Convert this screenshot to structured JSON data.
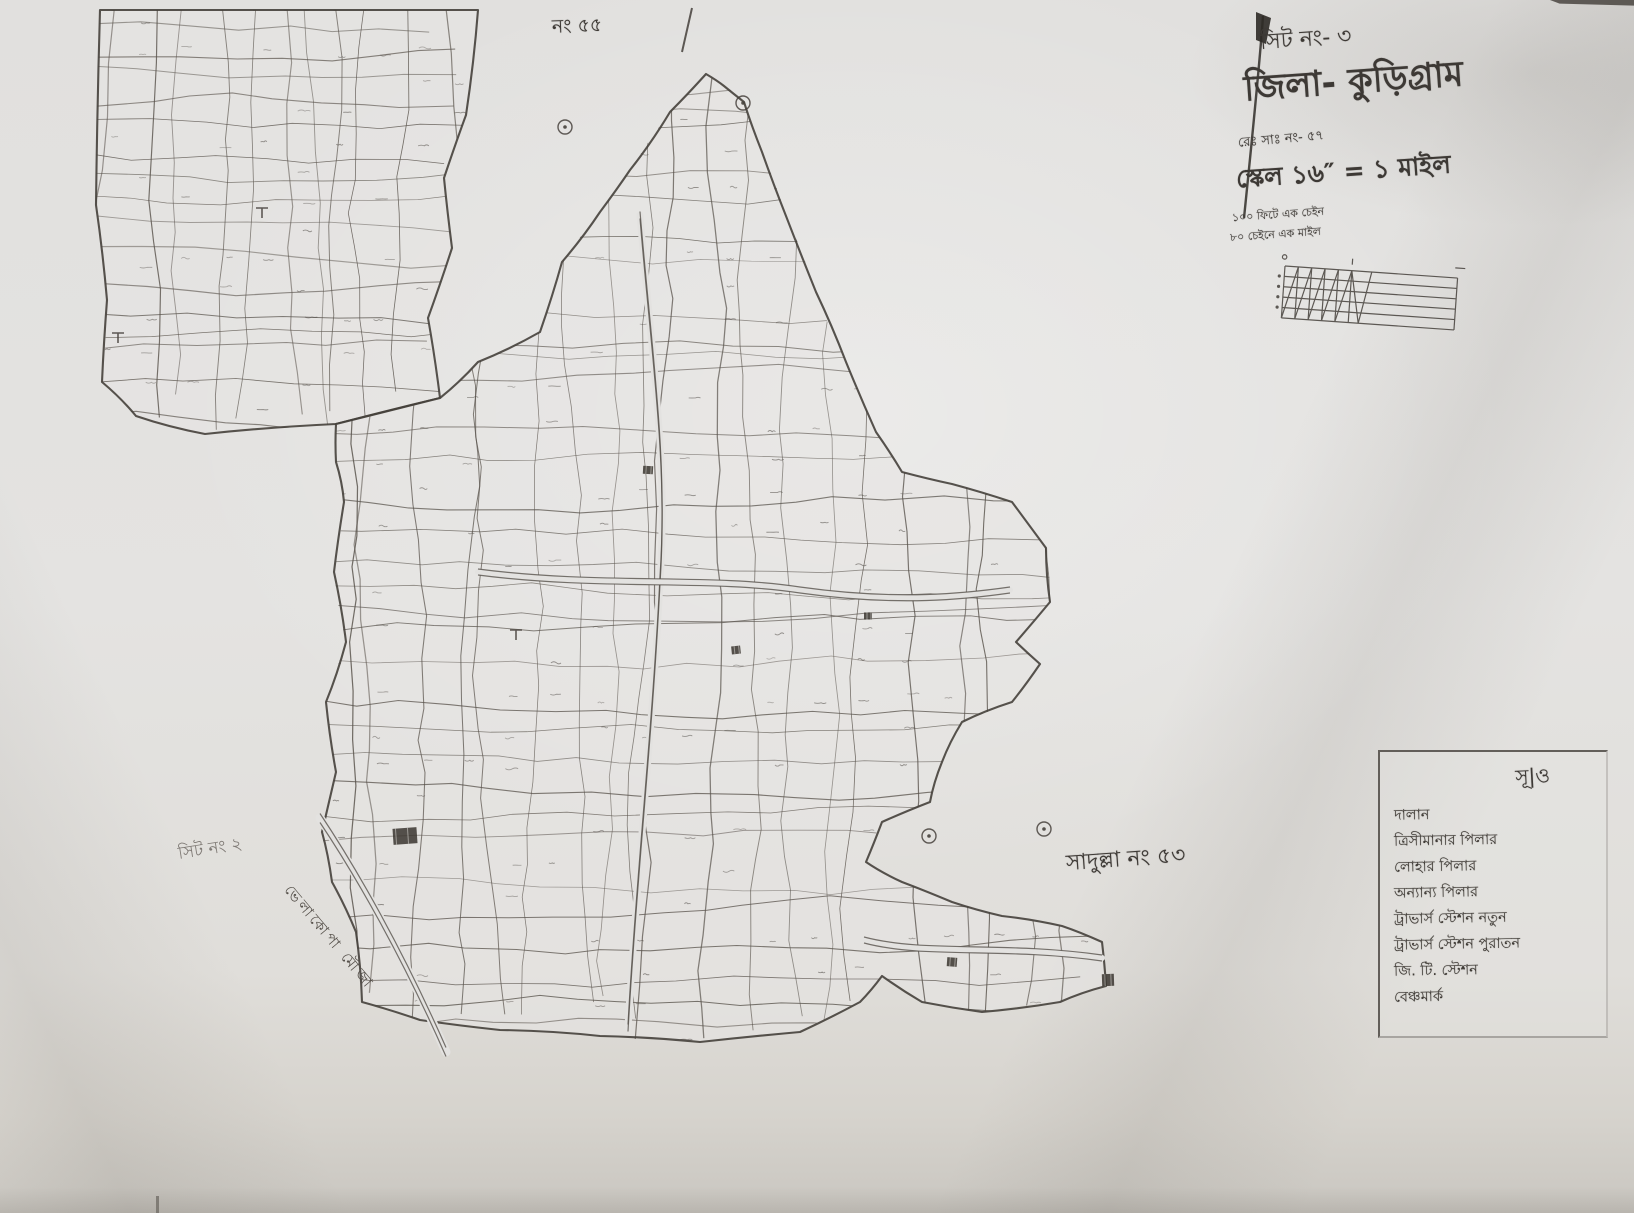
{
  "colors": {
    "paper": "#e3e2e0",
    "ink": "#45403b",
    "plot_line": "#5a544d",
    "faint_ink": "#6d6862"
  },
  "title_block": {
    "sheet_no": "সিট নং- ৩",
    "district": "জিলা- কুড়িগ্রাম",
    "rs_no": "রেঃ সাঃ নং- ৫৭",
    "scale": "স্কেল ১৬″ = ১ মাইল",
    "scale_note_1": "১০০ ফিটে এক চেইন",
    "scale_note_2": "৮০ চেইনে এক মাইল"
  },
  "map_labels": {
    "top_sheet_no": "নং ৫৫",
    "left_sheet_no": "সিট নং ২",
    "diagonal_boundary_label": "ভেলাকোপা মৌজা",
    "adjacent_mouza": "সাদুল্লা নং ৫৩"
  },
  "legend": {
    "header": "সূ|ও",
    "items": [
      {
        "label": "দালান"
      },
      {
        "label": "ত্রিসীমানার পিলার"
      },
      {
        "label": "লোহার পিলার"
      },
      {
        "label": "অন্যান্য পিলার"
      },
      {
        "label": "ট্রাভার্স স্টেশন নতুন"
      },
      {
        "label": "ট্রাভার্স স্টেশন পুরাতন"
      },
      {
        "label": "জি. টি. স্টেশন"
      },
      {
        "label": "বেঞ্চমার্ক"
      }
    ]
  }
}
